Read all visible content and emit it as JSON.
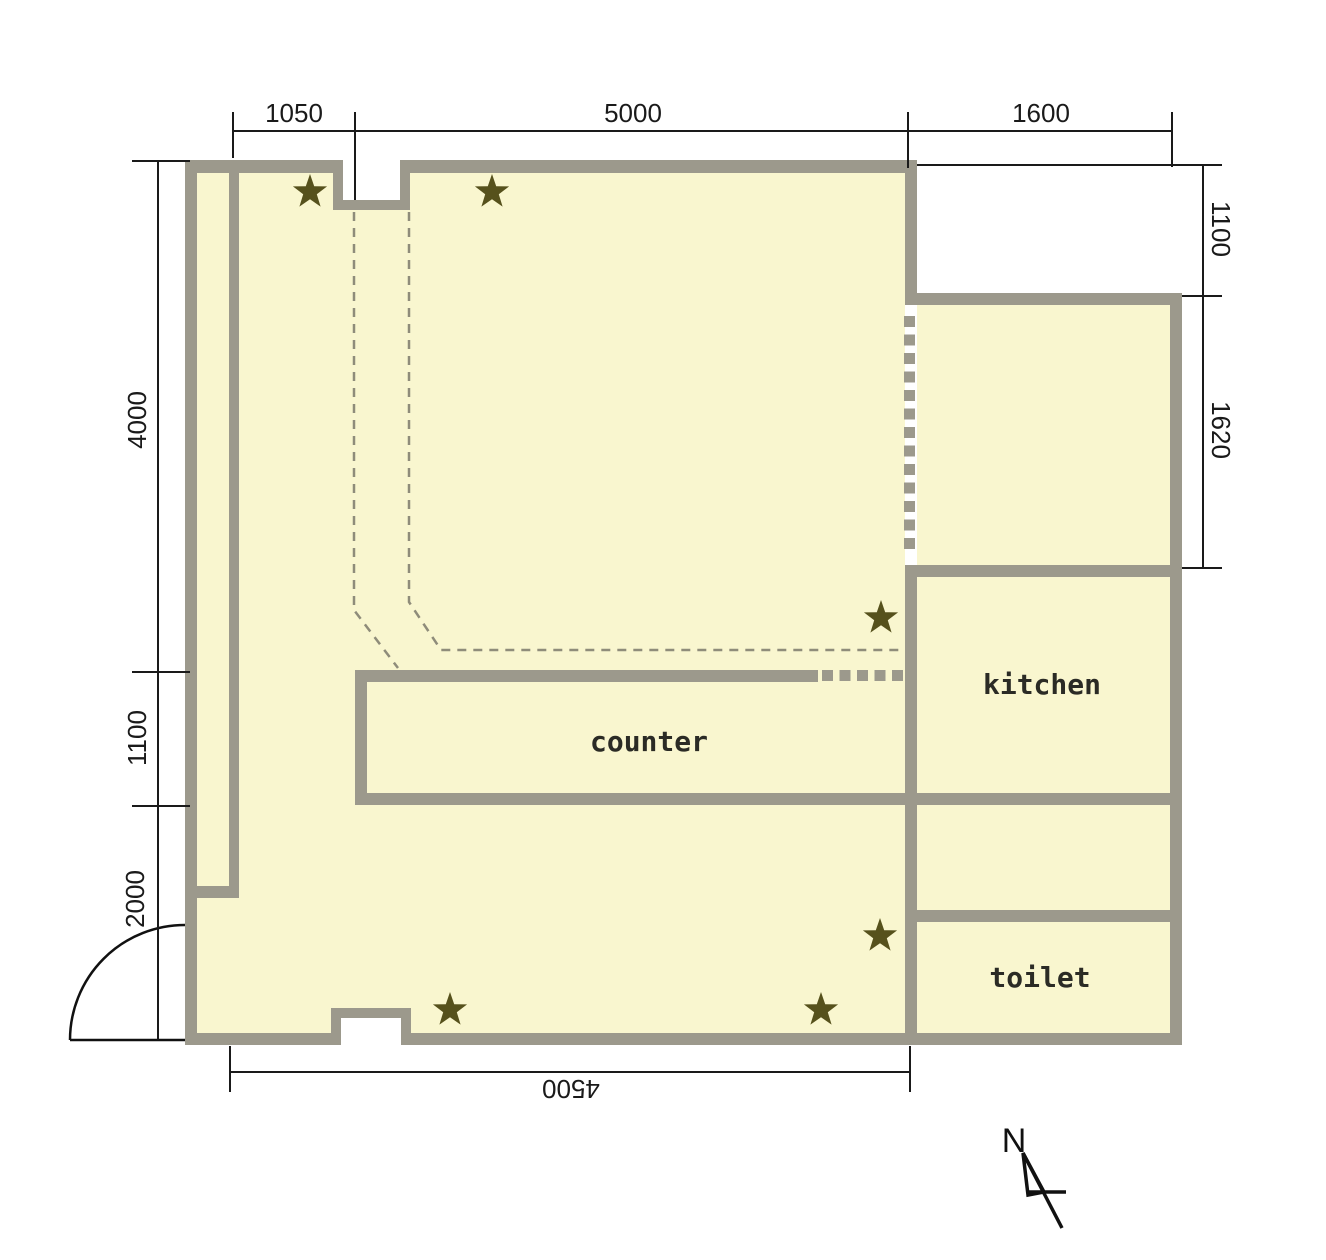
{
  "plan": {
    "rooms": {
      "kitchen": "kitchen",
      "counter": "counter",
      "toilet": "toilet"
    },
    "dimensions": {
      "top": {
        "d1050": "1050",
        "d5000": "5000",
        "d1600": "1600"
      },
      "left": {
        "d4000": "4000",
        "d1100": "1100",
        "d2000": "2000"
      },
      "right": {
        "d1100": "1100",
        "d1620": "1620"
      },
      "bottom": {
        "d4500": "4500"
      }
    },
    "compass": {
      "label": "N"
    },
    "stars": [
      [
        310,
        192
      ],
      [
        492,
        192
      ],
      [
        881,
        618
      ],
      [
        880,
        936
      ],
      [
        450,
        1010
      ],
      [
        821,
        1010
      ]
    ],
    "colors": {
      "background": "#FFFFFF",
      "floor": "#F9F6CF",
      "wall": "#9C998C",
      "dashed": "#8F8C7A",
      "star": "#56511C",
      "dim_line": "#1A1A1A",
      "label_text": "#2B2B25"
    }
  }
}
